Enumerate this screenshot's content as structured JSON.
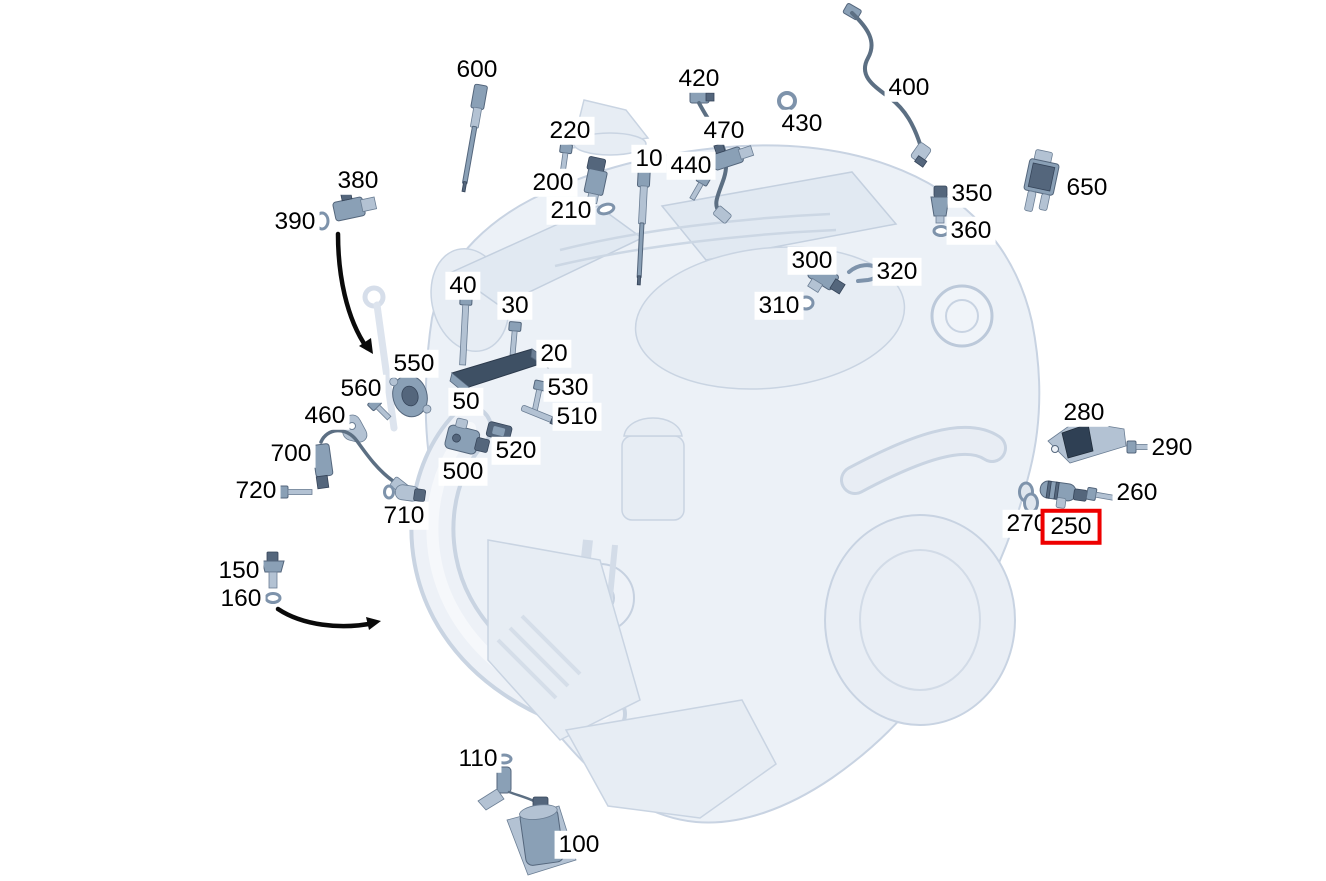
{
  "diagram": {
    "kind": "engine-sensor-parts-diagram",
    "highlight_color": "#ee0000",
    "part_color": "#8aa0b6",
    "selected_callout": "250"
  },
  "callouts": [
    {
      "label": "600",
      "x": 477,
      "y": 70
    },
    {
      "label": "420",
      "x": 699,
      "y": 79
    },
    {
      "label": "400",
      "x": 909,
      "y": 88
    },
    {
      "label": "430",
      "x": 802,
      "y": 124
    },
    {
      "label": "470",
      "x": 724,
      "y": 131
    },
    {
      "label": "220",
      "x": 570,
      "y": 131
    },
    {
      "label": "10",
      "x": 649,
      "y": 159
    },
    {
      "label": "440",
      "x": 691,
      "y": 166
    },
    {
      "label": "200",
      "x": 553,
      "y": 183
    },
    {
      "label": "650",
      "x": 1087,
      "y": 188
    },
    {
      "label": "350",
      "x": 972,
      "y": 194
    },
    {
      "label": "210",
      "x": 571,
      "y": 211
    },
    {
      "label": "380",
      "x": 358,
      "y": 181
    },
    {
      "label": "390",
      "x": 295,
      "y": 222
    },
    {
      "label": "360",
      "x": 971,
      "y": 231
    },
    {
      "label": "300",
      "x": 812,
      "y": 261
    },
    {
      "label": "320",
      "x": 897,
      "y": 272
    },
    {
      "label": "310",
      "x": 779,
      "y": 306
    },
    {
      "label": "40",
      "x": 463,
      "y": 286
    },
    {
      "label": "30",
      "x": 515,
      "y": 306
    },
    {
      "label": "20",
      "x": 554,
      "y": 354
    },
    {
      "label": "550",
      "x": 414,
      "y": 364
    },
    {
      "label": "560",
      "x": 361,
      "y": 389
    },
    {
      "label": "530",
      "x": 568,
      "y": 388
    },
    {
      "label": "50",
      "x": 466,
      "y": 402
    },
    {
      "label": "510",
      "x": 577,
      "y": 417
    },
    {
      "label": "460",
      "x": 325,
      "y": 416
    },
    {
      "label": "520",
      "x": 516,
      "y": 451
    },
    {
      "label": "500",
      "x": 463,
      "y": 472
    },
    {
      "label": "700",
      "x": 291,
      "y": 454
    },
    {
      "label": "720",
      "x": 256,
      "y": 491
    },
    {
      "label": "710",
      "x": 404,
      "y": 516
    },
    {
      "label": "280",
      "x": 1084,
      "y": 413
    },
    {
      "label": "290",
      "x": 1172,
      "y": 448
    },
    {
      "label": "260",
      "x": 1137,
      "y": 493
    },
    {
      "label": "270",
      "x": 1027,
      "y": 524
    },
    {
      "label": "250",
      "x": 1071,
      "y": 527,
      "highlighted": true
    },
    {
      "label": "150",
      "x": 239,
      "y": 571
    },
    {
      "label": "160",
      "x": 241,
      "y": 599
    },
    {
      "label": "110",
      "x": 478,
      "y": 759
    },
    {
      "label": "100",
      "x": 579,
      "y": 845
    }
  ]
}
